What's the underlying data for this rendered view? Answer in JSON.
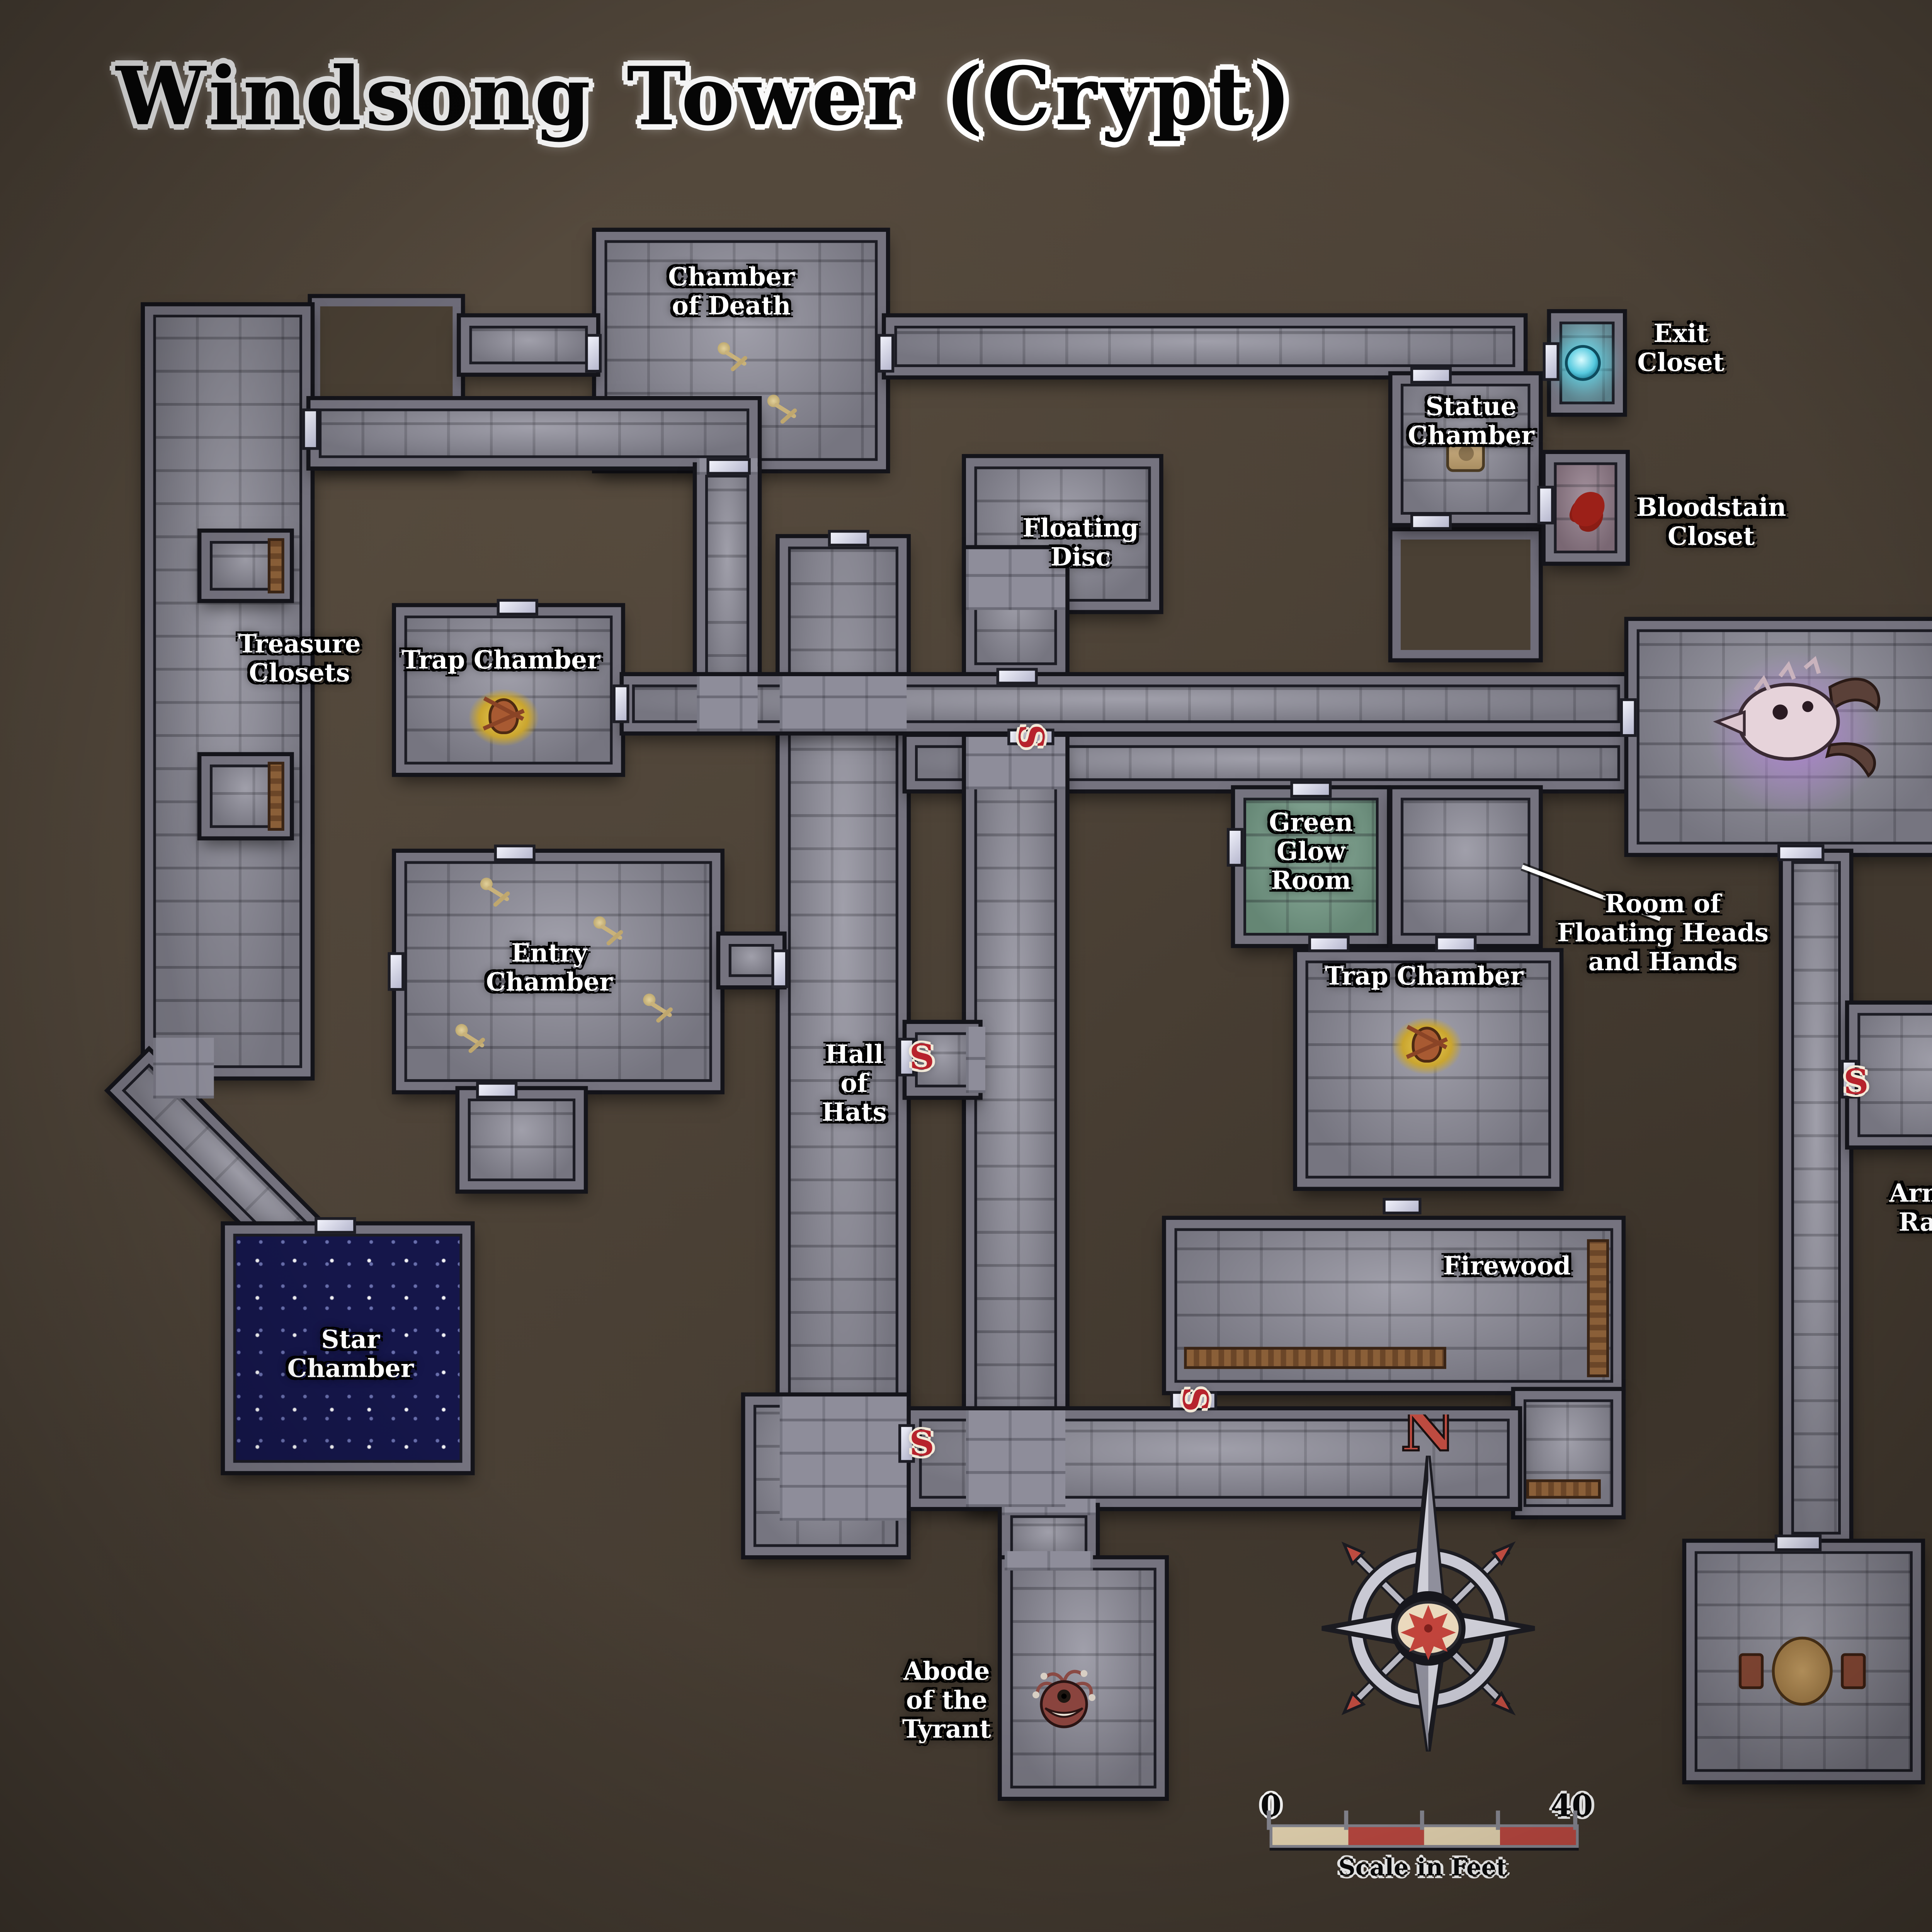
{
  "title": "Windsong Tower (Crypt)",
  "map": {
    "labels": [
      {
        "id": "chamber-of-death",
        "text": "Chamber\nof Death"
      },
      {
        "id": "exit-closet",
        "text": "Exit\nCloset"
      },
      {
        "id": "statue-chamber",
        "text": "Statue\nChamber"
      },
      {
        "id": "bloodstain-closet",
        "text": "Bloodstain\nCloset"
      },
      {
        "id": "floating-disc",
        "text": "Floating\nDisc"
      },
      {
        "id": "treasure-closets",
        "text": "Treasure\nClosets"
      },
      {
        "id": "trap-chamber-west",
        "text": "Trap Chamber"
      },
      {
        "id": "dragonskull-hall",
        "text": "Dragonskull\nHall"
      },
      {
        "id": "green-glow-room",
        "text": "Green\nGlow\nRoom"
      },
      {
        "id": "room-of-floating-heads",
        "text": "Room of\nFloating Heads\nand Hands"
      },
      {
        "id": "entry-chamber",
        "text": "Entry\nChamber"
      },
      {
        "id": "trap-chamber-east",
        "text": "Trap Chamber"
      },
      {
        "id": "hall-of-hats",
        "text": "Hall\nof\nHats"
      },
      {
        "id": "armor-rack",
        "text": "Armor\nRack"
      },
      {
        "id": "firewood",
        "text": "Firewood"
      },
      {
        "id": "star-chamber",
        "text": "Star\nChamber"
      },
      {
        "id": "abode-of-the-tyrant",
        "text": "Abode\nof the\nTyrant"
      },
      {
        "id": "ashes-to-ashes",
        "text": "Ashes\nto\nAshes"
      }
    ],
    "secret_door_marker": "S",
    "compass": {
      "north": "N"
    },
    "scale_bar": {
      "min": "0",
      "max": "40",
      "caption": "Scale in Feet"
    },
    "colors": {
      "background": "#4c4237",
      "floor": "#8e8d9a",
      "wall": "#75737f",
      "door": "#d9dbee",
      "secret_marker": "#b7232d",
      "star_chamber_floor": "#15164a",
      "green_glow": "#79a18c",
      "exit_closet_glow": "#56c9de",
      "bloodstain": "#9c2018",
      "dragonskull_glow": "#b07fd8",
      "scale_segment_light": "#ead9b5",
      "scale_segment_red": "#bf4a42"
    }
  }
}
